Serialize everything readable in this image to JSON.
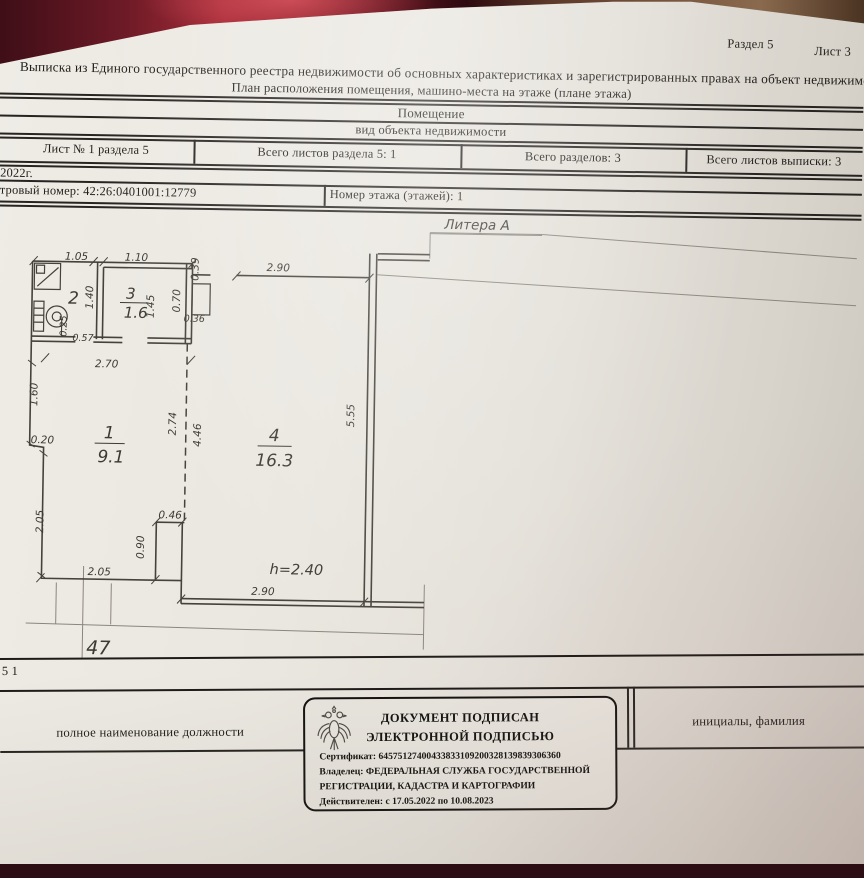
{
  "page": {
    "section_label": "Раздел 5",
    "sheet_label": "Лист 3"
  },
  "header": {
    "title": "Выписка из Единого государственного реестра недвижимости об основных характеристиках и зарегистрированных правах на объект недвижимости",
    "subtitle": "План расположения помещения, машино-места на этаже (плане этажа)",
    "object_type": "Помещение",
    "object_type_caption": "вид объекта недвижимости"
  },
  "meta_table": {
    "sheet_cell": "Лист № 1 раздела 5",
    "total_sheets_section": "Всего листов раздела 5: 1",
    "total_sections": "Всего разделов: 3",
    "total_sheets_extract": "Всего листов выписки: 3",
    "date_fragment": "2022г.",
    "cadastral_fragment": "тровый номер: 42:26:0401001:12779",
    "floor_number": "Номер этажа (этажей): 1"
  },
  "plan": {
    "litera": "Литера А",
    "apartment_number": "47",
    "height_note": "h=2.40",
    "rooms": {
      "room1": {
        "number": "1",
        "area": "9.1"
      },
      "room2": {
        "number": "2",
        "area": ""
      },
      "room3": {
        "number": "3",
        "area": "1.6"
      },
      "room4": {
        "number": "4",
        "area": "16.3"
      }
    },
    "dims": {
      "room2_width": "1.05",
      "room3_width": "1.10",
      "duct_offset": "0.39",
      "room4_width_top": "2.90",
      "room2_depth": "1.40",
      "room3_depth": "1.45",
      "duct_width": "0.70",
      "duct_depth": "0.36",
      "wc_niche_depth": "0.25",
      "wc_niche_width": "0.57",
      "room1_width_top": "2.70",
      "room1_left_upper": "1.60",
      "wall_step": "0.20",
      "boundary_upper": "2.74",
      "room4_left_height": "4.46",
      "room4_right_height": "5.55",
      "room1_left_lower": "2.05",
      "shaft_width": "0.46",
      "shaft_height": "0.90",
      "room1_width_bottom": "2.05",
      "room4_width_bottom": "2.90"
    }
  },
  "footer": {
    "page_fragment": "5 1",
    "position_caption": "полное наименование должности",
    "name_caption": "инициалы, фамилия"
  },
  "stamp": {
    "line1": "ДОКУМЕНТ ПОДПИСАН",
    "line2": "ЭЛЕКТРОННОЙ ПОДПИСЬЮ",
    "certificate": "Сертификат: 64575127400433833109200328139839306360",
    "owner_line1": "Владелец: ФЕДЕРАЛЬНАЯ СЛУЖБА ГОСУДАРСТВЕННОЙ",
    "owner_line2": "РЕГИСТРАЦИИ, КАДАСТРА И КАРТОГРАФИИ",
    "validity": "Действителен: с 17.05.2022 по 10.08.2023"
  },
  "colors": {
    "paper": "#e7e4dd",
    "ink": "#24211d",
    "backdrop_red": "#a62b38",
    "backdrop_brown": "#7a5740"
  }
}
